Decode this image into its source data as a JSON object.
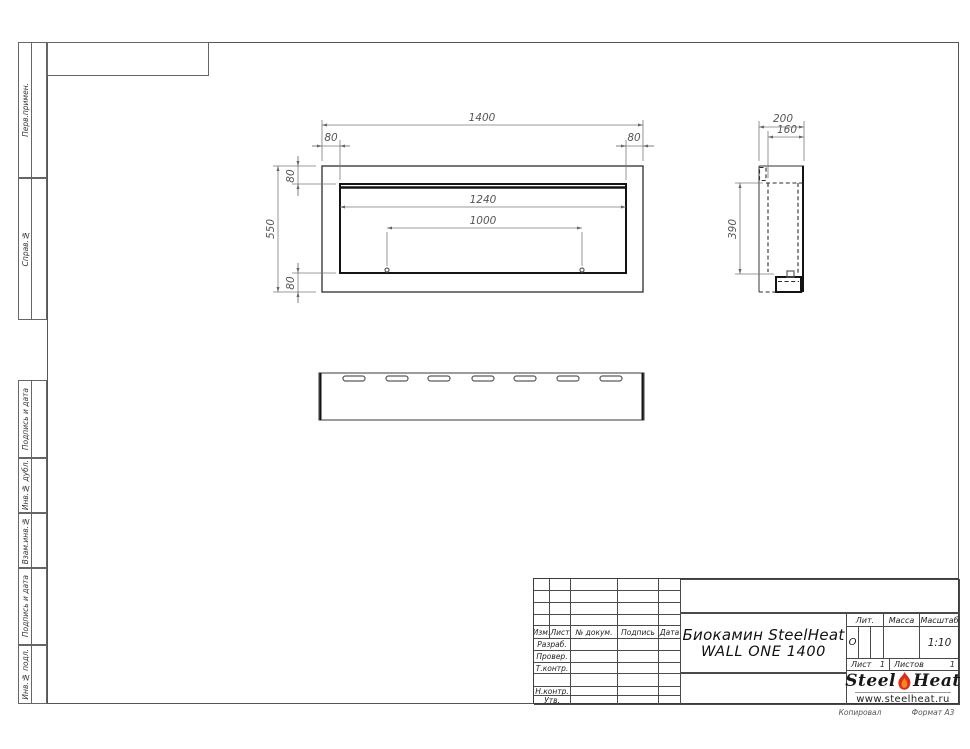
{
  "document": {
    "product_title_line1": "Биокамин SteelHeat",
    "product_title_line2": "WALL ONE 1400",
    "copied_label": "Копировал",
    "format_label": "Формат А3"
  },
  "left_margin": {
    "top": [
      "Перв.примен.",
      "Справ.№"
    ],
    "bottom": [
      "Подпись и дата",
      "Инв.№ дубл.",
      "Взам.инв.№",
      "Подпись и дата",
      "Инв.№ подл."
    ]
  },
  "dimensions": {
    "front": {
      "width": "1400",
      "height": "550",
      "offset_left": "80",
      "offset_right": "80",
      "offset_top": "80",
      "offset_bottom": "80",
      "opening_width": "1240",
      "mount_spacing": "1000"
    },
    "side": {
      "depth": "200",
      "inner_depth": "160",
      "inner_height": "390"
    }
  },
  "title_block": {
    "rev_header": [
      "Изм.",
      "Лист",
      "№ докум.",
      "Подпись",
      "Дата"
    ],
    "roles": [
      "Разраб.",
      "Провер.",
      "Т.контр.",
      "",
      "Н.контр.",
      "Утв."
    ],
    "lit_label": "Лит.",
    "lit_value": "О",
    "mass_label": "Масса",
    "scale_label": "Масштаб",
    "scale_value": "1:10",
    "sheet_label": "Лист",
    "sheet_value": "1",
    "sheets_label": "Листов",
    "sheets_total": "1",
    "logo_word1": "Steel",
    "logo_word2": "Heat",
    "website": "www.steelheat.ru"
  }
}
